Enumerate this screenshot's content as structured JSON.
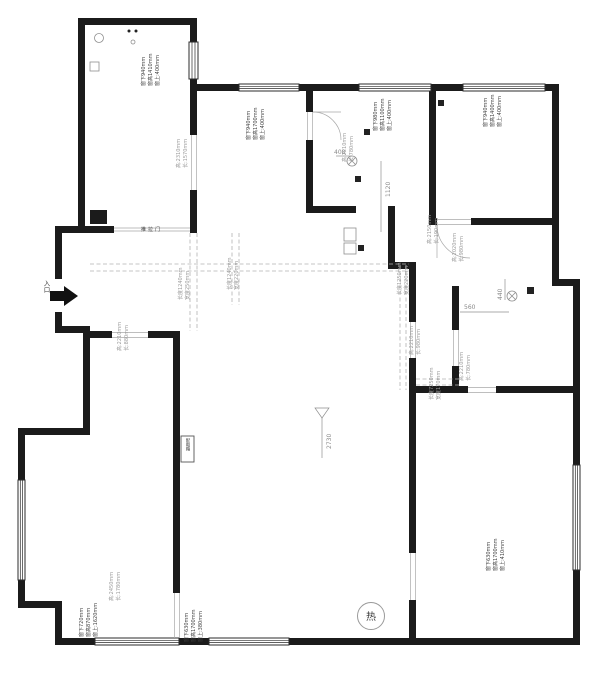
{
  "plan": {
    "entrance_label": "入口",
    "sliding_door_label": "推拉门",
    "distribution_box_label": "配电箱",
    "heater_label": "热",
    "ceiling_height_mark": "2730",
    "dims": {
      "bath_drain_x": "408",
      "bath_drain_y": "1120",
      "util_drain_y": "440",
      "util_drain_x": "560"
    },
    "window_labels": {
      "w1": [
        "窗上:400mm",
        "窗高1410mm",
        "窗下940mm"
      ],
      "w2": [
        "窗上:400mm",
        "窗高1700mm",
        "窗下940mm"
      ],
      "w3": [
        "窗上:400mm",
        "窗高1100mm",
        "窗下980mm"
      ],
      "w4": [
        "窗上:400mm",
        "窗高1400mm",
        "窗下940mm"
      ],
      "w5": [
        "窗上:1620mm",
        "窗高870mm",
        "窗下720mm"
      ],
      "w6": [
        "窗上:380mm",
        "窗高1700mm",
        "窗下630mm"
      ],
      "w7": [
        "窗上:410mm",
        "窗高1700mm",
        "窗下630mm"
      ]
    },
    "opening_labels": {
      "a": [
        "长:1570mm",
        "高:2310mm"
      ],
      "b": [
        "长:780mm",
        "高:2210mm"
      ],
      "c": [
        "长:980mm",
        "高:2020mm"
      ],
      "c2": [
        "长:190mm",
        "高:2150mm"
      ],
      "d": [
        "长:980mm",
        "高:2210mm"
      ],
      "e": [
        "长:780mm",
        "高:2210mm"
      ],
      "f": [
        "长:1780mm",
        "高:2450mm"
      ],
      "g": [
        "长:880mm",
        "高:2210mm"
      ]
    },
    "beam_labels": {
      "b1": [
        "宽度250mm",
        "长度1240mm"
      ],
      "b2": [
        "宽度220mm",
        "长度1240mm"
      ],
      "b3": [
        "宽度220mm",
        "长度1250mm"
      ],
      "b4": [
        "宽度170mm",
        "长度7250mm"
      ]
    }
  }
}
